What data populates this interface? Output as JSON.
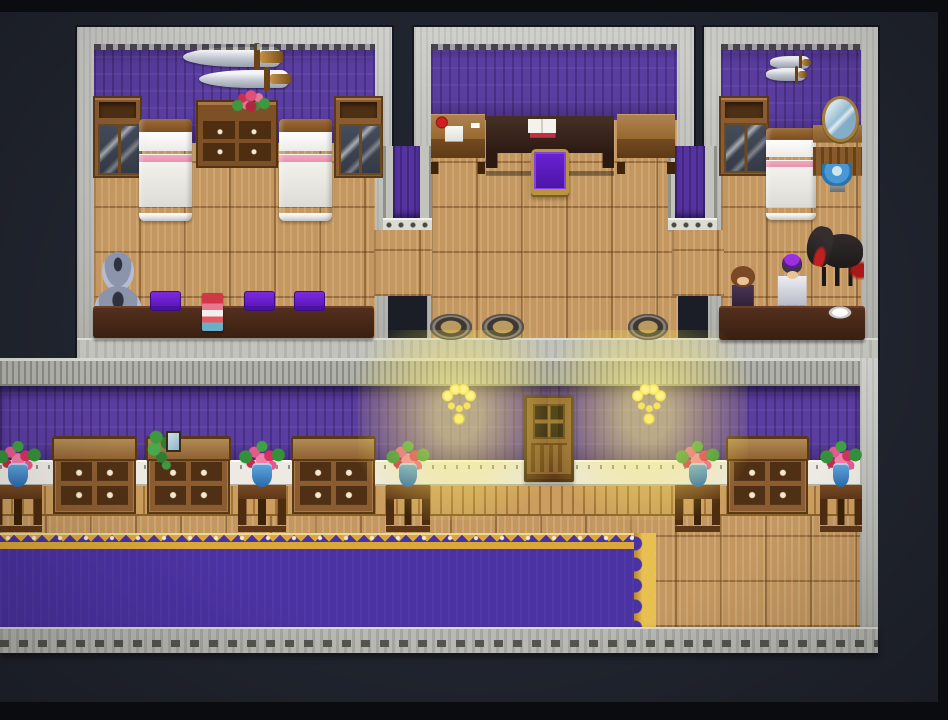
{
  "scene": {
    "title": "RPG interior map — three bedrooms above a carpeted hallway",
    "style": "16-bit tile RPG interior (RPG Maker style)",
    "palette": {
      "background": "#20242e",
      "stone_light": "#c2c3bd",
      "stone_dark": "#8f908a",
      "wall_purple": "#5a3da0",
      "wainscot_white": "#eceae2",
      "floor_wood": "#c49760",
      "carpet_purple": "#4b32a2",
      "carpet_gold": "#d8a83a",
      "wood_mid": "#8a5c30",
      "wood_dark": "#5a3814",
      "table_dark": "#45231a",
      "cushion_purple": "#6a1fd0",
      "bed_white": "#f6f5f1",
      "bed_pink": "#f2a8c0",
      "vase_blue": "#3a7ac0",
      "flower_pink": "#e85890",
      "leaf_green": "#3f9840",
      "glow_yellow": "#f8e858",
      "horse_black": "#241f1f",
      "mane_red": "#c02020"
    },
    "rooms": [
      {
        "id": "room-west",
        "label": "west bedroom with twin beds"
      },
      {
        "id": "room-center",
        "label": "center study room"
      },
      {
        "id": "room-east",
        "label": "east bedroom with NPCs"
      },
      {
        "id": "hallway",
        "label": "main hallway with purple carpet"
      }
    ]
  },
  "map": {
    "objects": [
      {
        "name": "wall-sword-long",
        "type": "sword",
        "label": "long sword wall trophy",
        "x": 183,
        "y": 47,
        "w": 98,
        "h": 20,
        "interactable": false
      },
      {
        "name": "wall-sword-short",
        "type": "sword",
        "label": "short sword wall trophy",
        "x": 199,
        "y": 70,
        "w": 90,
        "h": 18,
        "interactable": false
      },
      {
        "name": "wall-cabinet-west-left",
        "type": "wall-cabinet",
        "label": "glass-door cabinet",
        "x": 93,
        "y": 96,
        "w": 49,
        "h": 82,
        "interactable": false
      },
      {
        "name": "wall-cabinet-west-right",
        "type": "wall-cabinet",
        "label": "glass-door cabinet",
        "x": 334,
        "y": 96,
        "w": 49,
        "h": 82,
        "interactable": false
      },
      {
        "name": "dresser-between-beds",
        "type": "dresser",
        "label": "dresser with four drawers",
        "x": 196,
        "y": 100,
        "w": 82,
        "h": 68,
        "interactable": false
      },
      {
        "name": "dresser-flowers",
        "type": "bouquet",
        "label": "flower bouquet on dresser",
        "x": 230,
        "y": 88,
        "w": 42,
        "h": 30,
        "interactable": false
      },
      {
        "name": "bed-west-left",
        "type": "bed",
        "label": "bed with pink trim",
        "x": 139,
        "y": 119,
        "w": 53,
        "h": 102,
        "interactable": false
      },
      {
        "name": "bed-west-right",
        "type": "bed",
        "label": "bed with pink trim",
        "x": 279,
        "y": 119,
        "w": 53,
        "h": 102,
        "interactable": false
      },
      {
        "name": "stacked-vases",
        "type": "vase-stack",
        "label": "stacked ceramic jars",
        "x": 94,
        "y": 252,
        "w": 48,
        "h": 85,
        "interactable": false
      },
      {
        "name": "long-table-west",
        "type": "long-table",
        "label": "long dark table",
        "x": 93,
        "y": 306,
        "w": 281,
        "h": 32,
        "interactable": false
      },
      {
        "name": "cushion-1",
        "type": "cushion",
        "label": "purple seat cushion",
        "x": 150,
        "y": 291,
        "w": 31,
        "h": 20,
        "interactable": false
      },
      {
        "name": "cushion-2",
        "type": "cushion",
        "label": "purple seat cushion",
        "x": 244,
        "y": 291,
        "w": 31,
        "h": 20,
        "interactable": false
      },
      {
        "name": "cushion-3",
        "type": "cushion",
        "label": "purple seat cushion",
        "x": 294,
        "y": 291,
        "w": 31,
        "h": 20,
        "interactable": false
      },
      {
        "name": "book-stack",
        "type": "book-stack",
        "label": "stack of books",
        "x": 202,
        "y": 293,
        "w": 21,
        "h": 38,
        "interactable": false
      },
      {
        "name": "writing-desk-left",
        "type": "side-desk",
        "variant": "items",
        "label": "writing desk with apple, paper and quill",
        "x": 431,
        "y": 114,
        "w": 54,
        "h": 60,
        "interactable": false
      },
      {
        "name": "study-desk",
        "type": "study-desk",
        "label": "dark study desk with open book",
        "x": 486,
        "y": 116,
        "w": 128,
        "h": 60,
        "interactable": false
      },
      {
        "name": "desk-chair",
        "type": "throne",
        "label": "gold-framed purple chair",
        "x": 531,
        "y": 149,
        "w": 38,
        "h": 44,
        "interactable": false
      },
      {
        "name": "writing-desk-right",
        "type": "side-desk",
        "label": "writing desk",
        "x": 617,
        "y": 114,
        "w": 58,
        "h": 60,
        "interactable": false
      },
      {
        "name": "floor-pot-1",
        "type": "floor-pot",
        "label": "round floor pot",
        "x": 430,
        "y": 314,
        "w": 42,
        "h": 26,
        "interactable": false
      },
      {
        "name": "floor-pot-2",
        "type": "floor-pot",
        "label": "round floor pot",
        "x": 482,
        "y": 314,
        "w": 42,
        "h": 26,
        "interactable": false
      },
      {
        "name": "floor-pot-3",
        "type": "floor-pot",
        "label": "round floor pot",
        "x": 628,
        "y": 314,
        "w": 40,
        "h": 26,
        "interactable": false
      },
      {
        "name": "wall-dagger-top",
        "type": "sword",
        "label": "dagger wall trophy",
        "x": 770,
        "y": 56,
        "w": 40,
        "h": 13,
        "interactable": false
      },
      {
        "name": "wall-dagger-bottom",
        "type": "sword",
        "label": "dagger wall trophy",
        "x": 766,
        "y": 68,
        "w": 40,
        "h": 13,
        "interactable": false
      },
      {
        "name": "wall-cabinet-east",
        "type": "wall-cabinet",
        "label": "glass-door cabinet",
        "x": 719,
        "y": 96,
        "w": 50,
        "h": 80,
        "interactable": false
      },
      {
        "name": "bed-east",
        "type": "bed",
        "label": "bed with pink trim",
        "x": 766,
        "y": 128,
        "w": 50,
        "h": 92,
        "interactable": false
      },
      {
        "name": "vanity-dresser",
        "type": "vanity",
        "label": "vanity with oval mirror",
        "x": 813,
        "y": 96,
        "w": 49,
        "h": 80,
        "interactable": false
      },
      {
        "name": "water-basin",
        "type": "basin",
        "label": "blue wash basin",
        "x": 822,
        "y": 164,
        "w": 30,
        "h": 28,
        "interactable": false
      },
      {
        "name": "black-horse",
        "type": "horse",
        "label": "black horse with red mane",
        "x": 804,
        "y": 226,
        "w": 60,
        "h": 60,
        "interactable": true
      },
      {
        "name": "npc-attendant",
        "type": "npc-villager",
        "label": "attendant NPC",
        "x": 729,
        "y": 266,
        "w": 28,
        "h": 44,
        "interactable": true
      },
      {
        "name": "npc-knight",
        "type": "npc-knight",
        "label": "armored NPC with purple plume",
        "x": 775,
        "y": 256,
        "w": 34,
        "h": 54,
        "interactable": true
      },
      {
        "name": "counter-east",
        "type": "long-table",
        "label": "dark counter table",
        "x": 719,
        "y": 306,
        "w": 146,
        "h": 34,
        "interactable": false
      },
      {
        "name": "white-dish",
        "type": "dish",
        "label": "white dish",
        "x": 828,
        "y": 306,
        "w": 24,
        "h": 13,
        "interactable": false
      },
      {
        "name": "flower-stand-1",
        "type": "hall-stand",
        "label": "flower stand (cut off at screen edge)",
        "x": -6,
        "y": 438,
        "w": 48,
        "h": 94,
        "interactable": false
      },
      {
        "name": "sideboard-1",
        "type": "hall-dresser",
        "label": "wooden sideboard",
        "x": 53,
        "y": 436,
        "w": 83,
        "h": 78,
        "interactable": false
      },
      {
        "name": "sideboard-2",
        "type": "hall-dresser",
        "label": "wooden sideboard",
        "x": 147,
        "y": 436,
        "w": 83,
        "h": 78,
        "interactable": false
      },
      {
        "name": "vine-plant",
        "type": "vine",
        "label": "trailing green plant",
        "x": 146,
        "y": 430,
        "w": 34,
        "h": 40,
        "interactable": false
      },
      {
        "name": "small-picture",
        "type": "picture",
        "label": "small picture frame",
        "x": 166,
        "y": 431,
        "w": 15,
        "h": 21,
        "interactable": false
      },
      {
        "name": "flower-stand-2",
        "type": "hall-stand",
        "label": "flower stand",
        "x": 238,
        "y": 438,
        "w": 48,
        "h": 94,
        "interactable": false
      },
      {
        "name": "sideboard-3",
        "type": "hall-dresser",
        "label": "wooden sideboard",
        "x": 292,
        "y": 436,
        "w": 83,
        "h": 78,
        "interactable": false
      },
      {
        "name": "flower-stand-3",
        "type": "hall-stand",
        "label": "flower stand",
        "x": 386,
        "y": 438,
        "w": 44,
        "h": 94,
        "interactable": false
      },
      {
        "name": "hall-door",
        "type": "door",
        "label": "wooden hallway door",
        "x": 524,
        "y": 395,
        "w": 50,
        "h": 87,
        "interactable": true
      },
      {
        "name": "flower-stand-4",
        "type": "hall-stand",
        "label": "flower stand",
        "x": 675,
        "y": 438,
        "w": 45,
        "h": 94,
        "interactable": false
      },
      {
        "name": "sideboard-4",
        "type": "hall-dresser",
        "label": "wooden sideboard",
        "x": 727,
        "y": 436,
        "w": 81,
        "h": 78,
        "interactable": false
      },
      {
        "name": "flower-stand-5",
        "type": "hall-stand",
        "label": "flower stand",
        "x": 820,
        "y": 438,
        "w": 42,
        "h": 94,
        "interactable": false
      },
      {
        "name": "wall-sconce-left",
        "type": "sconce",
        "label": "candle wall sconce",
        "x": 440,
        "y": 382,
        "w": 38,
        "h": 46,
        "interactable": false
      },
      {
        "name": "wall-sconce-right",
        "type": "sconce",
        "label": "candle wall sconce",
        "x": 630,
        "y": 382,
        "w": 38,
        "h": 46,
        "interactable": false
      },
      {
        "name": "sconce-glow-left",
        "type": "glow",
        "label": "warm candle glow",
        "x": 358,
        "y": 330,
        "w": 200,
        "h": 190,
        "interactable": false
      },
      {
        "name": "sconce-glow-right",
        "type": "glow",
        "label": "warm candle glow",
        "x": 548,
        "y": 330,
        "w": 200,
        "h": 190,
        "interactable": false
      }
    ]
  }
}
